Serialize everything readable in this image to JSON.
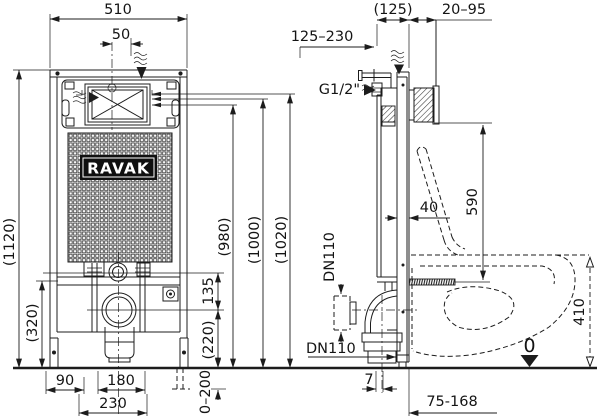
{
  "brand": {
    "logo_text": "RAVAK"
  },
  "front_view": {
    "dim_width": "510",
    "dim_inlet_offset": "50",
    "dim_total_height": "(1120)",
    "dim_lower_frame_height": "(320)",
    "dim_stud_to_drain": "135",
    "dim_drain_height": "(220)",
    "dim_panel_height_1": "(980)",
    "dim_panel_height_2": "(1000)",
    "dim_panel_height_3": "(1020)",
    "dim_foot_offset": "90",
    "dim_stud_spacing": "180",
    "dim_anchor_spacing": "230",
    "dim_foot_adjust": "0–200"
  },
  "side_view": {
    "dim_module_depth": "(125)",
    "dim_wall_gap": "20–95",
    "dim_finished_wall_range": "125–230",
    "label_water_inlet": "G1/2\"",
    "dim_profile_depth": "40",
    "dim_bracket_height": "590",
    "label_drain_top": "DN110",
    "label_drain_bottom": "DN110",
    "dim_pipe_offset": "7",
    "dim_floor_outlet_range": "75-168",
    "dim_bowl_height": "410",
    "datum_zero": "0"
  }
}
